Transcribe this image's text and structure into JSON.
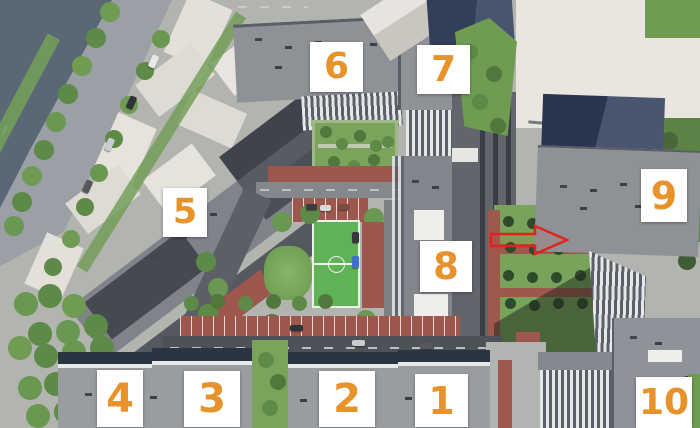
{
  "scene": {
    "kind": "aerial-3d-masterplan-render",
    "building_markers_total": 10
  },
  "markers": [
    {
      "number": "1"
    },
    {
      "number": "2"
    },
    {
      "number": "3"
    },
    {
      "number": "4"
    },
    {
      "number": "5"
    },
    {
      "number": "6"
    },
    {
      "number": "7"
    },
    {
      "number": "8"
    },
    {
      "number": "9"
    },
    {
      "number": "10"
    }
  ],
  "annotation_arrow": {
    "direction": "right",
    "style": "outline",
    "color": "#e0241c"
  },
  "palette": {
    "marker_background": "#ffffff",
    "marker_number": "#e8922b",
    "water": "#5a6876",
    "field_green": "#5fb356",
    "brick_red": "#9d574d",
    "roof_gray": "#8e9196",
    "roof_navy": "#2c374e",
    "asphalt": "#4c5056",
    "grass": "#79a35a"
  }
}
